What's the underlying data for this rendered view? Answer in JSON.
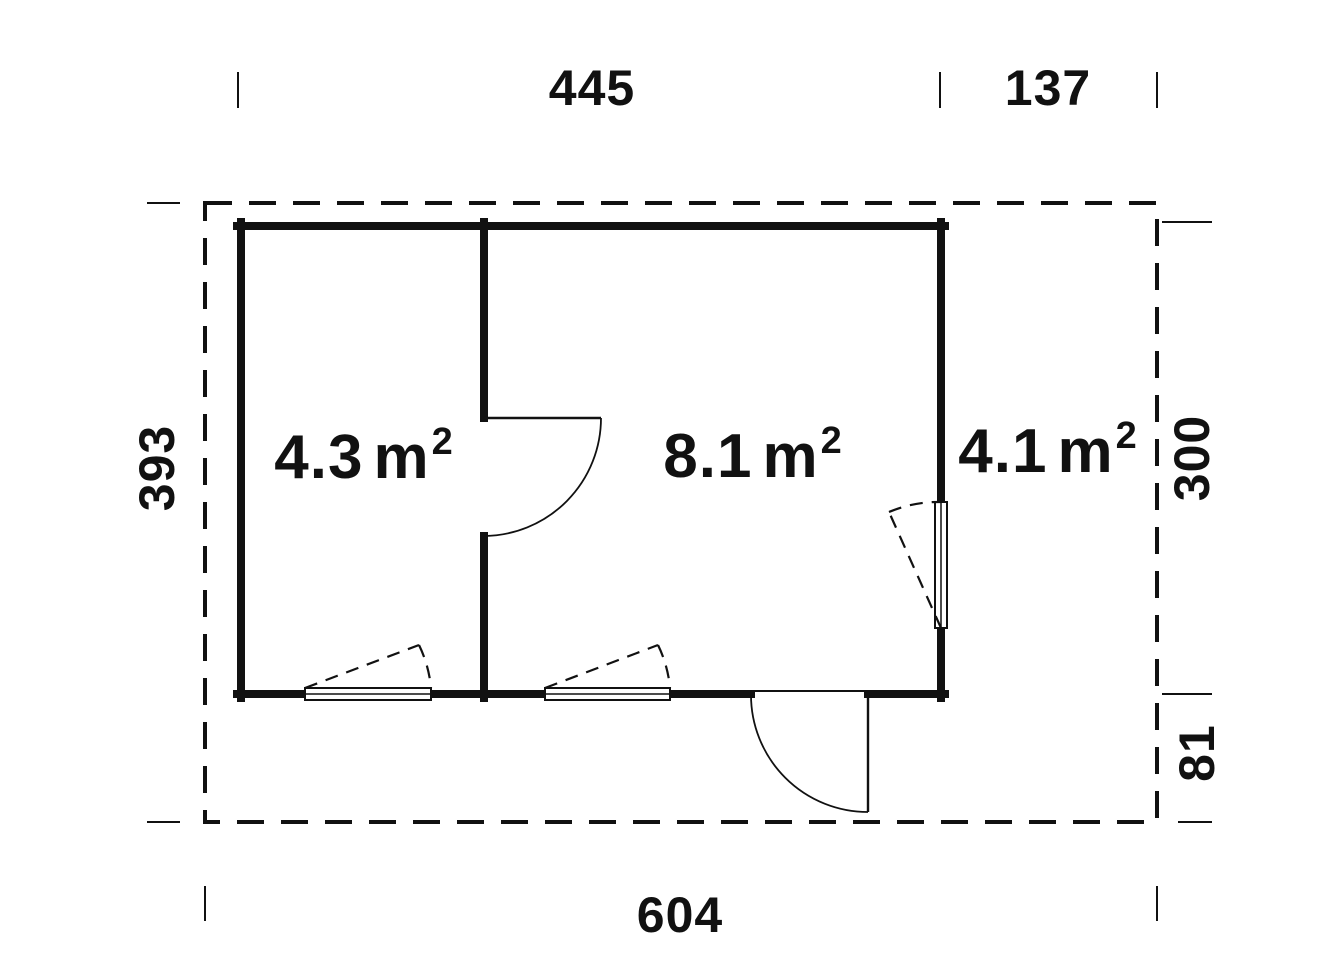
{
  "drawing": {
    "type": "floor-plan",
    "background_color": "#ffffff",
    "line_color": "#111111"
  },
  "dimension_labels": {
    "building_width": "445",
    "terrace_width": "137",
    "total_depth": "393",
    "building_depth": "300",
    "porch_depth": "81",
    "total_width": "604"
  },
  "room_labels": [
    {
      "id": "left-room",
      "value": "4.3",
      "unit": "m",
      "sup": "2"
    },
    {
      "id": "main-room",
      "value": "8.1",
      "unit": "m",
      "sup": "2"
    },
    {
      "id": "terrace",
      "value": "4.1",
      "unit": "m",
      "sup": "2"
    }
  ]
}
